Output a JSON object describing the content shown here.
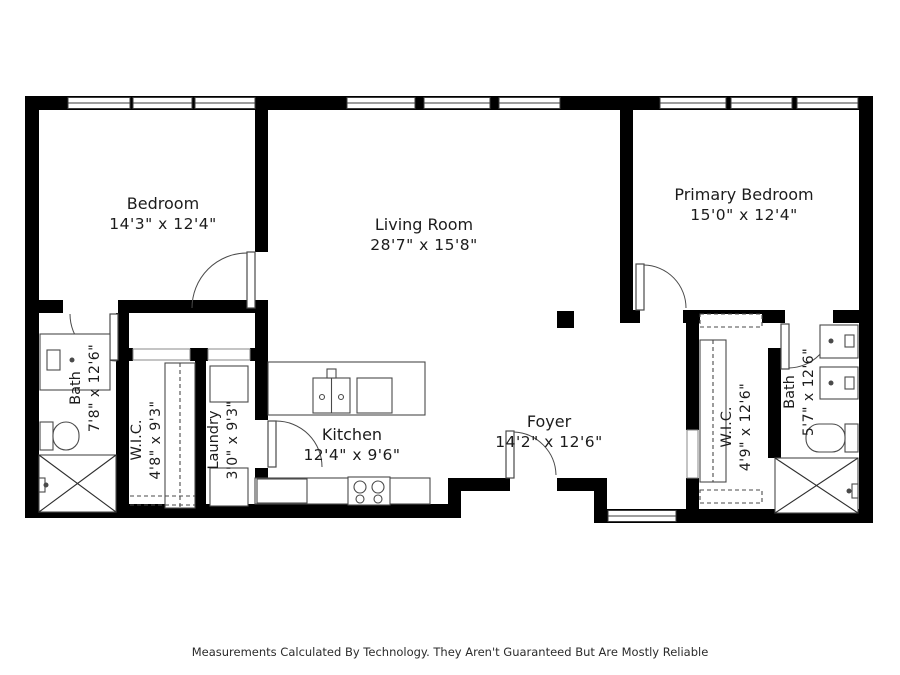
{
  "rooms": {
    "bedroom": {
      "name": "Bedroom",
      "dims": "14'3\" x 12'4\""
    },
    "living_room": {
      "name": "Living Room",
      "dims": "28'7\" x 15'8\""
    },
    "primary_bedroom": {
      "name": "Primary Bedroom",
      "dims": "15'0\" x 12'4\""
    },
    "bath_left": {
      "name": "Bath",
      "dims": "7'8\" x 12'6\""
    },
    "wic_left": {
      "name": "W.I.C.",
      "dims": "4'8\" x 9'3\""
    },
    "laundry": {
      "name": "Laundry",
      "dims": "3'0\" x 9'3\""
    },
    "kitchen": {
      "name": "Kitchen",
      "dims": "12'4\" x 9'6\""
    },
    "foyer": {
      "name": "Foyer",
      "dims": "14'2\" x 12'6\""
    },
    "wic_right": {
      "name": "W.I.C.",
      "dims": "4'9\" x 12'6\""
    },
    "bath_right": {
      "name": "Bath",
      "dims": "5'7\" x 12'6\""
    }
  },
  "footer": {
    "disclaimer": "Measurements Calculated By Technology. They Aren't Guaranteed But Are Mostly Reliable"
  },
  "colors": {
    "wall": "#000000",
    "fixture_line": "#4a4a4a",
    "background": "#ffffff"
  }
}
